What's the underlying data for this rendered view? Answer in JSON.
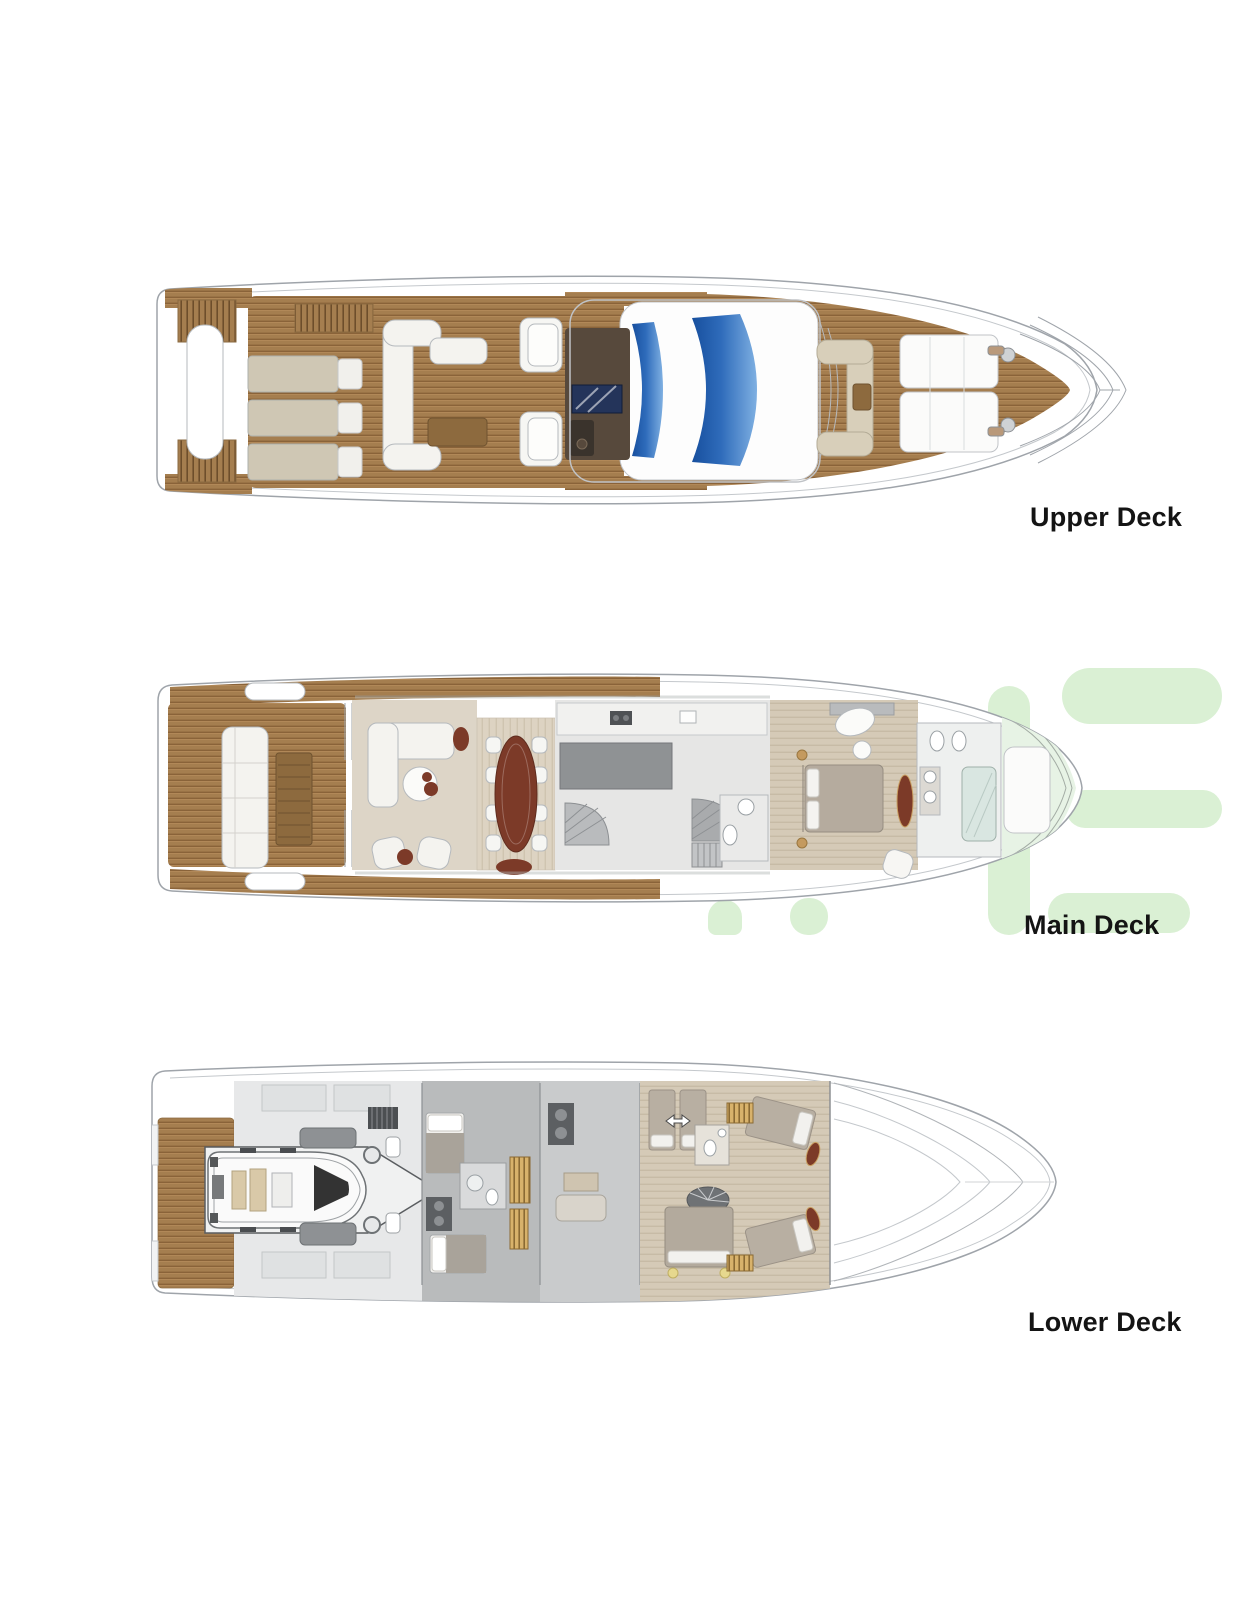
{
  "page": {
    "title": "Yacht deck plans",
    "background": "#ffffff"
  },
  "decks": [
    {
      "id": "upper-deck",
      "label": "Upper Deck",
      "features": [
        "transom-stairs",
        "aft-sun-loungers",
        "sky-lounge-sofa",
        "coffee-table",
        "helm-companion-seats",
        "bar-tv-cabinet",
        "glass-sunroof-bands",
        "foredeck-lounge-seat",
        "bow-sun-pads",
        "anchor-winches",
        "bow-pulpit"
      ]
    },
    {
      "id": "main-deck",
      "label": "Main Deck",
      "features": [
        "side-decks",
        "aft-cockpit-sofa",
        "cockpit-table",
        "salon-l-sofa",
        "round-coffee-table",
        "salon-armchairs",
        "dining-table-8-seats",
        "galley",
        "day-head",
        "staircases",
        "master-cabin-bed",
        "vanity-desk",
        "master-bathroom",
        "bow-windshield",
        "bow-sun-pad"
      ]
    },
    {
      "id": "lower-deck",
      "label": "Lower Deck",
      "features": [
        "swim-platform",
        "tender-garage",
        "rib-tender",
        "garage-cradle",
        "crew-cabins",
        "laundry",
        "twin-guest-cabin",
        "convertible-beds-arrow",
        "double-guest-cabin",
        "vip-cabin-port",
        "vip-cabin-starboard",
        "guest-bathrooms",
        "spiral-staircase",
        "bow-hull-stringers"
      ]
    }
  ],
  "watermark": {
    "color": "#daf0d4",
    "shape": "partial-logo-letters"
  },
  "colors": {
    "teak": "#a57e4f",
    "teak_stripe": "#8a6339",
    "hull_line": "#9fa4aa",
    "light_line": "#c4c8cc",
    "cushion_white": "#f4f3ef",
    "beige": "#cfc7b4",
    "dark_bar": "#57493c",
    "tv_navy": "#24345a",
    "glass_blue": "#2f6cbb",
    "maroon": "#7c3a28",
    "salon_carpet": "#ddd5c7",
    "cabin_wood": "#d5cab7",
    "gray_floor": "#b9bbbc",
    "garage_gray": "#e7e8e9",
    "gold_hatch": "#d8b26b",
    "taupe_bed": "#b8afa2",
    "glass_green": "#e7f3e5",
    "watermark_green": "#daf0d4",
    "label_black": "#141414"
  }
}
